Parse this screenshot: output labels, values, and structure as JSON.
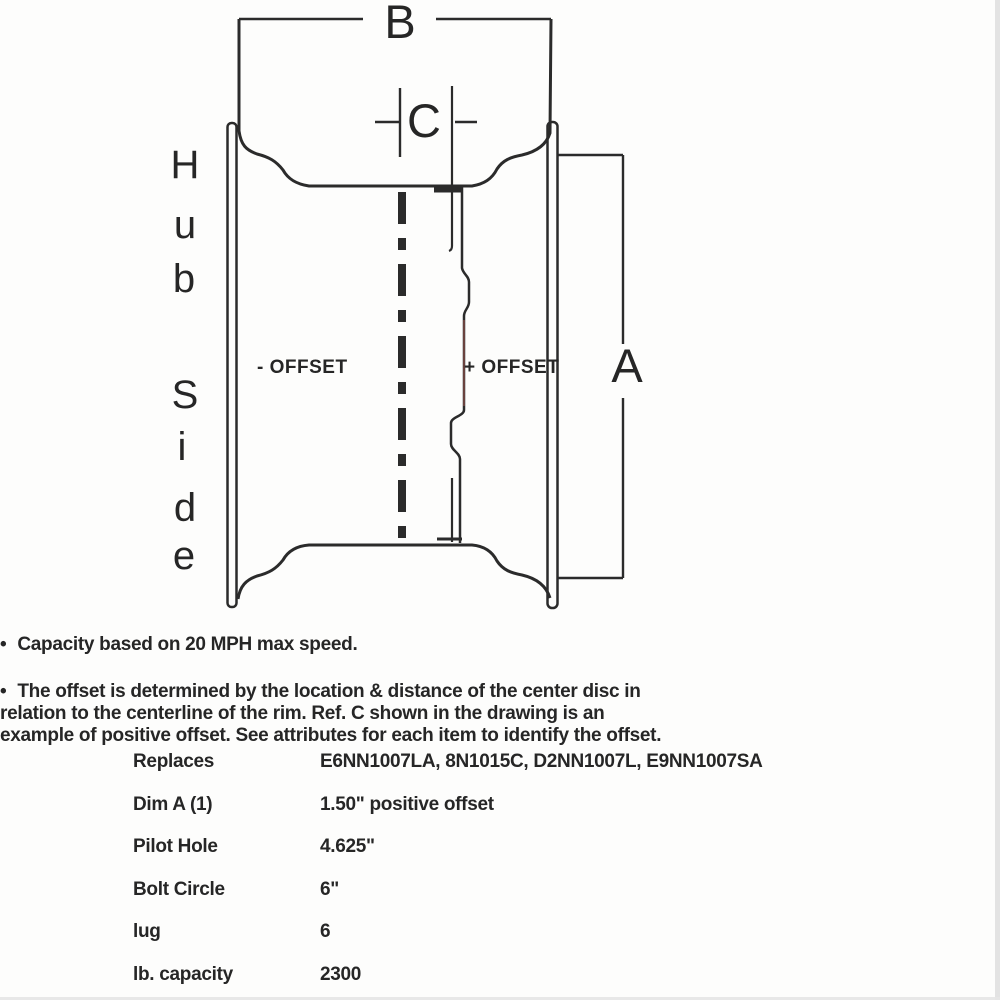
{
  "diagram": {
    "dim_b_label": "B",
    "dim_c_label": "C",
    "dim_a_label": "A",
    "neg_offset_label": "- OFFSET",
    "pos_offset_label": "+ OFFSET",
    "hub_side_text": "Hub Side",
    "hub_letters": [
      "H",
      "u",
      "b",
      "S",
      "i",
      "d",
      "e"
    ],
    "line_color": "#2b2b2b",
    "text_color": "#262626",
    "disc_tint_color": "#8a4f48"
  },
  "notes": [
    {
      "bullet": "•",
      "lines": [
        "Capacity based on 20 MPH max speed."
      ]
    },
    {
      "bullet": "•",
      "lines": [
        "The offset is determined by the location & distance of the center disc in",
        "relation to the centerline of the rim. Ref. C shown in the drawing is an",
        "example of positive offset. See attributes for each item to identify the offset."
      ]
    }
  ],
  "specs": [
    {
      "label": "Replaces",
      "value": "E6NN1007LA, 8N1015C, D2NN1007L, E9NN1007SA"
    },
    {
      "label": "Dim A (1)",
      "value": "1.50\" positive offset"
    },
    {
      "label": "Pilot Hole",
      "value": "4.625\""
    },
    {
      "label": "Bolt Circle",
      "value": "6\""
    },
    {
      "label": "lug",
      "value": "6"
    },
    {
      "label": "lb. capacity",
      "value": "2300"
    }
  ]
}
